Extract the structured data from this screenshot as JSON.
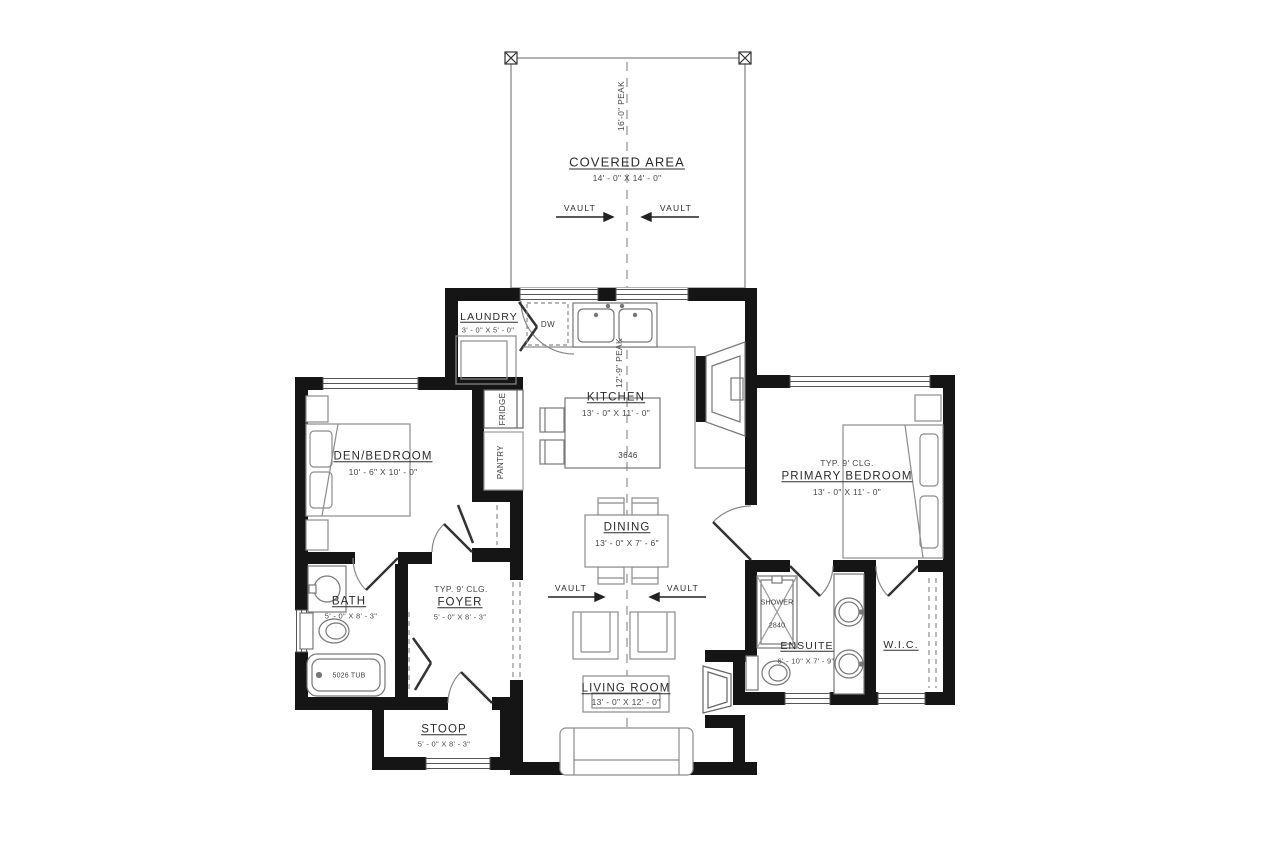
{
  "rooms": {
    "covered": {
      "label": "COVERED AREA",
      "dims": "14' - 0\" X 14' - 0\""
    },
    "laundry": {
      "label": "LAUNDRY",
      "dims": "3' - 0\" X 5' - 0\""
    },
    "kitchen": {
      "label": "KITCHEN",
      "dims": "13' - 0\" X 11' - 0\""
    },
    "den": {
      "label": "DEN/BEDROOM",
      "dims": "10' - 6\" X 10' - 0\""
    },
    "primary": {
      "ceiling": "TYP. 9' CLG.",
      "label": "PRIMARY BEDROOM",
      "dims": "13' - 0\" X 11' - 0\""
    },
    "dining": {
      "label": "DINING",
      "dims": "13' - 0\" X 7' - 6\""
    },
    "bath": {
      "label": "BATH",
      "dims": "5' - 0\" X 8' - 3\""
    },
    "foyer": {
      "ceiling": "TYP. 9' CLG.",
      "label": "FOYER",
      "dims": "5' - 0\" X 8' - 3\""
    },
    "living": {
      "label": "LIVING ROOM",
      "dims": "13' - 0\" X 12' - 0\""
    },
    "ensuite": {
      "label": "ENSUITE",
      "dims": "6' - 10\" X 7' - 9\""
    },
    "wic": {
      "label": "W.I.C."
    },
    "stoop": {
      "label": "STOOP",
      "dims": "5' - 0\" X 8' - 3\""
    }
  },
  "fixtures": {
    "dishwasher": "DW",
    "fridge": "FRIDGE",
    "pantry": "PANTRY",
    "shower": "SHOWER",
    "shower_size": "2840",
    "tub": "5026 TUB",
    "island_size": "3646"
  },
  "annotations": {
    "vault": "VAULT",
    "peak_upper": "16'-0\" PEAK",
    "peak_lower": "12'-9\" PEAK"
  },
  "colors": {
    "wall": "#151515",
    "furniture_line": "#8c8c8c",
    "text": "#2b2b2b"
  }
}
